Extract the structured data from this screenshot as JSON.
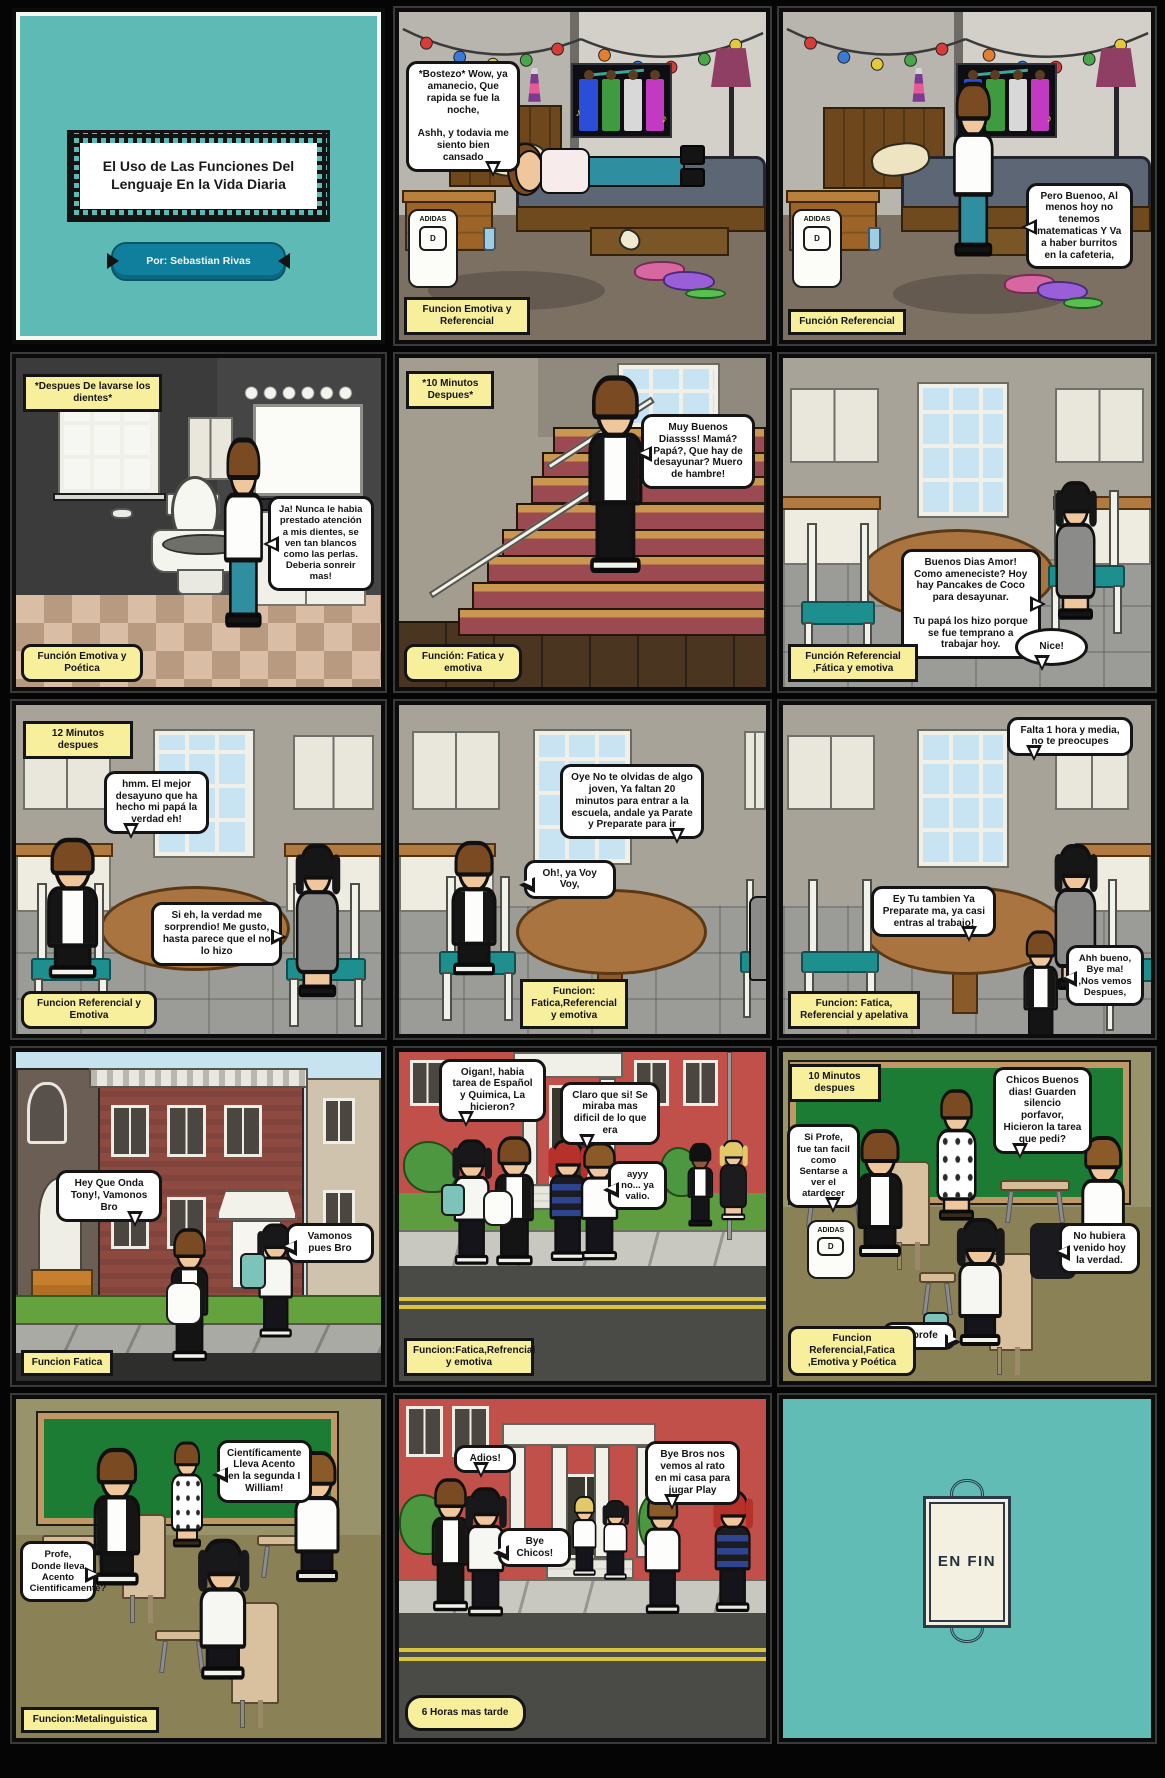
{
  "colors": {
    "teal_bg": "#5ebab4",
    "label_yellow": "#f8ef9c",
    "bubble_white": "#ffffff",
    "panel_border": "#0c0c0c",
    "author_plate_blue": "#0f7f9d",
    "chalkboard_green": "#1c7c33",
    "school_red": "#c2504a",
    "road_yellow": "#d8c53a",
    "chair_teal": "#1d8f8f"
  },
  "icons": {
    "music_note": "♪"
  },
  "title_panel": {
    "title": "El Uso de Las Funciones Del Lenguaje En la Vida Diaria",
    "author": "Por: Sebastian Rivas"
  },
  "backpack": {
    "brand": "ADIDAS",
    "letter": "D"
  },
  "panels": {
    "p2": {
      "label": "Funcion Emotiva y Referencial",
      "bubbles": [
        "*Bostezo* Wow, ya amanecio, Que rapida se fue la noche,\n\nAshh, y todavia me siento bien cansado"
      ]
    },
    "p3": {
      "label": "Función Referencial",
      "bubbles": [
        "Pero Buenoo, Al menos hoy no tenemos matematicas Y Va a haber burritos en la cafeteria,"
      ]
    },
    "p4": {
      "caption": "*Despues De lavarse los dientes*",
      "label": "Función Emotiva y Poética",
      "bubbles": [
        "Ja! Nunca le habia prestado atención a mis dientes, se ven tan blancos como las perlas. Deberia sonreir mas!"
      ]
    },
    "p5": {
      "caption": "*10 Minutos Despues*",
      "label": "Función: Fatica y emotiva",
      "bubbles": [
        "Muy Buenos Diassss! Mamá? Papá?, Que hay de desayunar? Muero de hambre!"
      ]
    },
    "p6": {
      "label": "Función Referencial ,Fática y emotiva",
      "bubbles": [
        "Buenos Dias Amor! Como ameneciste? Hoy hay Pancakes de Coco para desayunar.\n\nTu papá los hizo porque se fue temprano a trabajar hoy.",
        "Nice!"
      ]
    },
    "p7": {
      "caption": "12 Minutos despues",
      "label": "Funcion Referencial y Emotiva",
      "bubbles": [
        "hmm. El mejor desayuno que ha hecho mi papá la verdad eh!",
        "Si eh, la verdad me sorprendio! Me gusto, hasta parece que el no lo hizo"
      ]
    },
    "p8": {
      "label": "Funcion: Fatica,Referencial y emotiva",
      "bubbles": [
        "Oye No te olvidas de algo joven, Ya faltan 20 minutos para entrar a la escuela, andale ya Parate y Preparate para ir",
        "Oh!, ya Voy Voy,"
      ]
    },
    "p9": {
      "label": "Funcion: Fatica, Referencial y apelativa",
      "bubbles": [
        "Falta 1 hora y media, no te preocupes",
        "Ey Tu tambien Ya Preparate ma, ya casi entras al trabajo!",
        "Ahh bueno, Bye ma! ,Nos vemos Despues,"
      ]
    },
    "p10": {
      "label": "Funcion Fatica",
      "bubbles": [
        "Hey Que Onda Tony!, Vamonos Bro",
        "Vamonos pues Bro"
      ]
    },
    "p11": {
      "label": "Funcion:Fatica,Refrencial y emotiva",
      "bubbles": [
        "Oigan!, habia tarea de Español y Quimica, La hicieron?",
        "Claro que si! Se miraba mas dificil de lo que era",
        "ayyy no... ya valio."
      ]
    },
    "p12": {
      "caption": "10 Minutos despues",
      "label": "Funcion Referencial,Fatica ,Emotiva y Poética",
      "bubbles": [
        "Chicos Buenos dias! Guarden silencio porfavor, Hicieron la tarea que pedi?",
        "Si Profe, fue tan facil como Sentarse a ver el atardecer",
        "No hubiera venido hoy la verdad.",
        "Si profe"
      ]
    },
    "p13": {
      "label": "Funcion:Metalinguistica",
      "bubbles": [
        "Científicamente Lleva Acento en la segunda I William!",
        "Profe, Donde lleva Acento Cientificamente?"
      ]
    },
    "p14": {
      "caption": "6 Horas mas tarde",
      "bubbles": [
        "Adios!",
        "Bye Chicos!",
        "Bye Bros nos vemos al rato en mi casa para jugar Play"
      ]
    },
    "p15": {
      "end_text": "EN FIN"
    }
  }
}
